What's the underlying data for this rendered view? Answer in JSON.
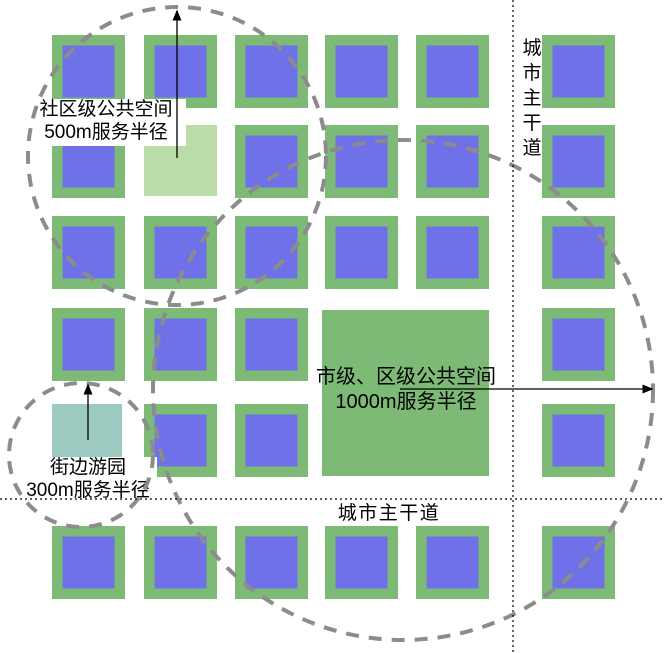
{
  "diagram": {
    "colors": {
      "background": "#FFFFFF",
      "block_green": "#7CBA76",
      "block_blue": "#6F71E8",
      "community_green": "#B9DCA9",
      "garden_teal": "#9CC9C0",
      "circle_gray": "#8C8C8C",
      "road_black": "#000000",
      "text_black": "#000000",
      "label_bg": "#FFFFFF"
    },
    "grid": {
      "col_x": [
        52,
        144,
        235,
        325,
        416,
        542
      ],
      "row_y": [
        35,
        125,
        216,
        308,
        404,
        526
      ],
      "block_size": 73,
      "inner_inset": 10.5,
      "inner_size": 52,
      "omit_cells": [
        [
          1,
          1
        ],
        [
          4,
          0
        ],
        [
          3,
          3
        ],
        [
          3,
          4
        ],
        [
          4,
          3
        ],
        [
          4,
          4
        ]
      ]
    },
    "special_spaces": [
      {
        "id": "community-public-space",
        "x": 144,
        "y": 125,
        "w": 73,
        "h": 71,
        "color_key": "community_green"
      },
      {
        "id": "street-garden-space",
        "x": 52,
        "y": 404,
        "w": 70,
        "h": 72,
        "color_key": "garden_teal"
      },
      {
        "id": "city-district-space",
        "x": 322,
        "y": 310,
        "w": 167,
        "h": 166,
        "color_key": "block_green"
      }
    ],
    "service_circles": [
      {
        "id": "service-radius-500m",
        "cx": 177,
        "cy": 156,
        "r": 149
      },
      {
        "id": "service-radius-300m",
        "cx": 81,
        "cy": 455,
        "r": 72
      },
      {
        "id": "service-radius-1000m",
        "cx": 403,
        "cy": 390,
        "r": 250
      }
    ],
    "roads": [
      {
        "id": "main-road-vertical",
        "x1": 513,
        "y1": 0,
        "x2": 513,
        "y2": 653
      },
      {
        "id": "main-road-horizontal",
        "x1": 0,
        "y1": 499,
        "x2": 664,
        "y2": 499
      }
    ],
    "arrows": [
      {
        "id": "radius-arrow-500m",
        "x1": 177,
        "y1": 158,
        "x2": 177,
        "y2": 11
      },
      {
        "id": "radius-arrow-300m",
        "x1": 88,
        "y1": 440,
        "x2": 88,
        "y2": 385
      },
      {
        "id": "radius-arrow-1000m",
        "x1": 400,
        "y1": 389,
        "x2": 652,
        "y2": 389
      }
    ],
    "labels": [
      {
        "id": "label-community-space",
        "lines": [
          "社区级公共空间",
          "500m服务半径"
        ],
        "cx": 106,
        "top": 99,
        "font": 19,
        "line_h": 23,
        "bg": true,
        "bg_box": [
          26,
          99,
          160,
          47
        ]
      },
      {
        "id": "label-street-garden",
        "lines": [
          "街边游园",
          "300m服务半径"
        ],
        "cx": 88,
        "top": 457,
        "font": 19,
        "line_h": 23,
        "bg": true,
        "bg_box": [
          20,
          457,
          137,
          44
        ]
      },
      {
        "id": "label-city-space",
        "lines": [
          "市级、区级公共空间",
          "1000m服务半径"
        ],
        "cx": 406,
        "top": 367,
        "font": 20,
        "line_h": 25,
        "bg": false,
        "bg_box": null
      }
    ],
    "road_labels": [
      {
        "id": "label-main-road-vertical",
        "text": "城市主干道",
        "orientation": "vertical",
        "x": 532,
        "top": 38,
        "font": 19,
        "char_pitch": 25
      },
      {
        "id": "label-main-road-horizontal",
        "text": "城市主干道",
        "orientation": "horizontal",
        "x": 389,
        "y": 519,
        "font": 19,
        "letter_spacing": 1.5
      }
    ]
  }
}
